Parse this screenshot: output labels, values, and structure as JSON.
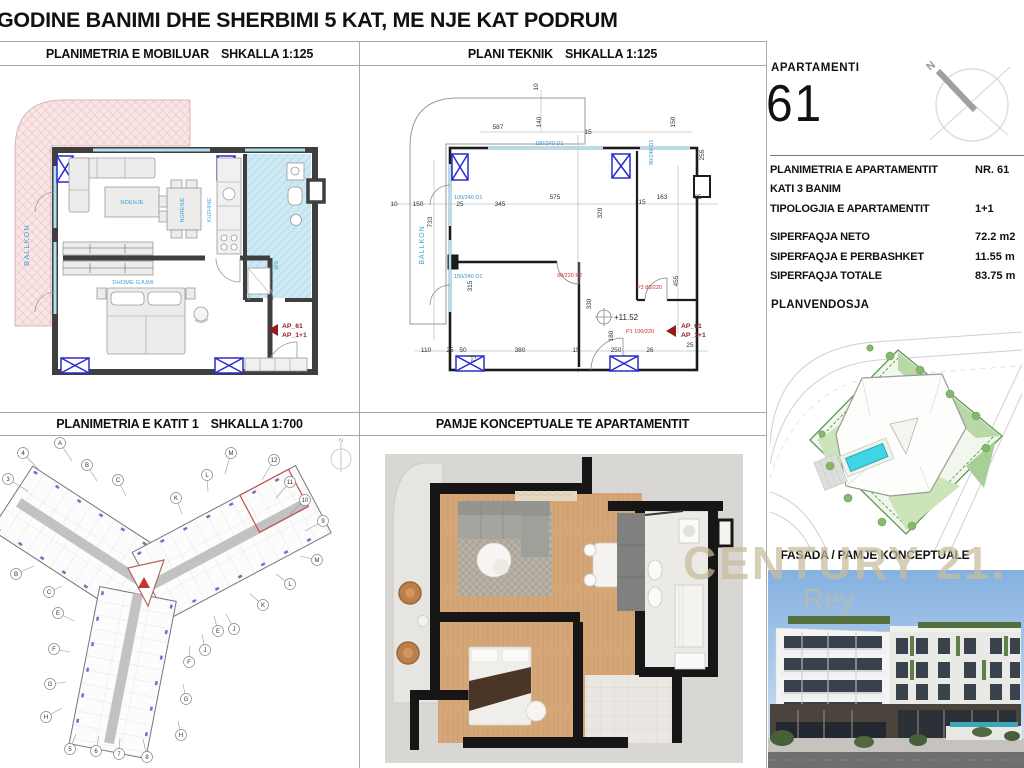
{
  "sheet": {
    "title": "GODINE BANIMI DHE SHERBIMI 5 KAT, ME NJE KAT PODRUM"
  },
  "panels": {
    "furnished": {
      "title": "PLANIMETRIA E MOBILUAR",
      "scale": "SHKALLA 1:125"
    },
    "technical": {
      "title": "PLANI TEKNIK",
      "scale": "SHKALLA 1:125"
    },
    "floor1": {
      "title": "PLANIMETRIA E KATIT 1",
      "scale": "SHKALLA 1:700"
    },
    "concept": {
      "title": "PAMJE KONCEPTUALE TE APARTAMENTIT"
    },
    "fasada": {
      "title": "FASADA / PAMJE KONCEPTUALE"
    },
    "siteplan": {
      "title": "PLANVENDOSJA"
    }
  },
  "apartment": {
    "label": "APARTAMENTI",
    "number": "61",
    "north": "N",
    "rows": [
      {
        "label": "PLANIMETRIA E APARTAMENTIT",
        "value": "NR. 61"
      },
      {
        "label": "KATI 3 BANIM",
        "value": ""
      },
      {
        "label": "TIPOLOGJIA E APARTAMENTIT",
        "value": "1+1"
      }
    ],
    "areas": [
      {
        "label": "SIPERFAQJA NETO",
        "value": "72.2 m2"
      },
      {
        "label": "SIPERFAQJA E PERBASHKET",
        "value": "11.55 m"
      },
      {
        "label": "SIPERFAQJA TOTALE",
        "value": "83.75 m"
      }
    ]
  },
  "furnished_plan": {
    "rooms": {
      "balcony": "BALLKON",
      "living": "NDENJE",
      "dining": "NGRENIE",
      "kitchen": "KUZHINE",
      "bedroom": "DHOME GJUMI",
      "bath": "WS"
    },
    "marker": {
      "line1": "AP_61",
      "line2": "AP_1+1"
    }
  },
  "technical_plan": {
    "balcony": "BALLKON",
    "elevation": "+11.52",
    "marker": {
      "line1": "AP_61",
      "line2": "AP_1+1"
    },
    "doors_blue": [
      "180/240 D1",
      "100/240 D1",
      "150/240 D1",
      "90/240 D1"
    ],
    "doors_red": [
      "90/220 P2",
      "P3 80/220",
      "P1 100/220"
    ],
    "dims": [
      "587",
      "140",
      "10",
      "15",
      "150",
      "10",
      "150",
      "733",
      "25",
      "345",
      "575",
      "320",
      "15",
      "163",
      "25",
      "455",
      "315",
      "330",
      "180",
      "110",
      "25",
      "50",
      "73",
      "380",
      "15",
      "250",
      "26",
      "255",
      "25"
    ]
  },
  "floor1_plan": {
    "north": "N",
    "bubbles": [
      "4",
      "A",
      "B",
      "3",
      "C",
      "M",
      "12",
      "L",
      "11",
      "K",
      "10",
      "9",
      "M",
      "L",
      "B",
      "C",
      "K",
      "E",
      "J",
      "E",
      "F",
      "J",
      "F",
      "G",
      "G",
      "H",
      "H",
      "5",
      "6",
      "7",
      "8"
    ]
  },
  "watermark": {
    "line1": "CENTURY 21.",
    "line2": "Rey"
  }
}
